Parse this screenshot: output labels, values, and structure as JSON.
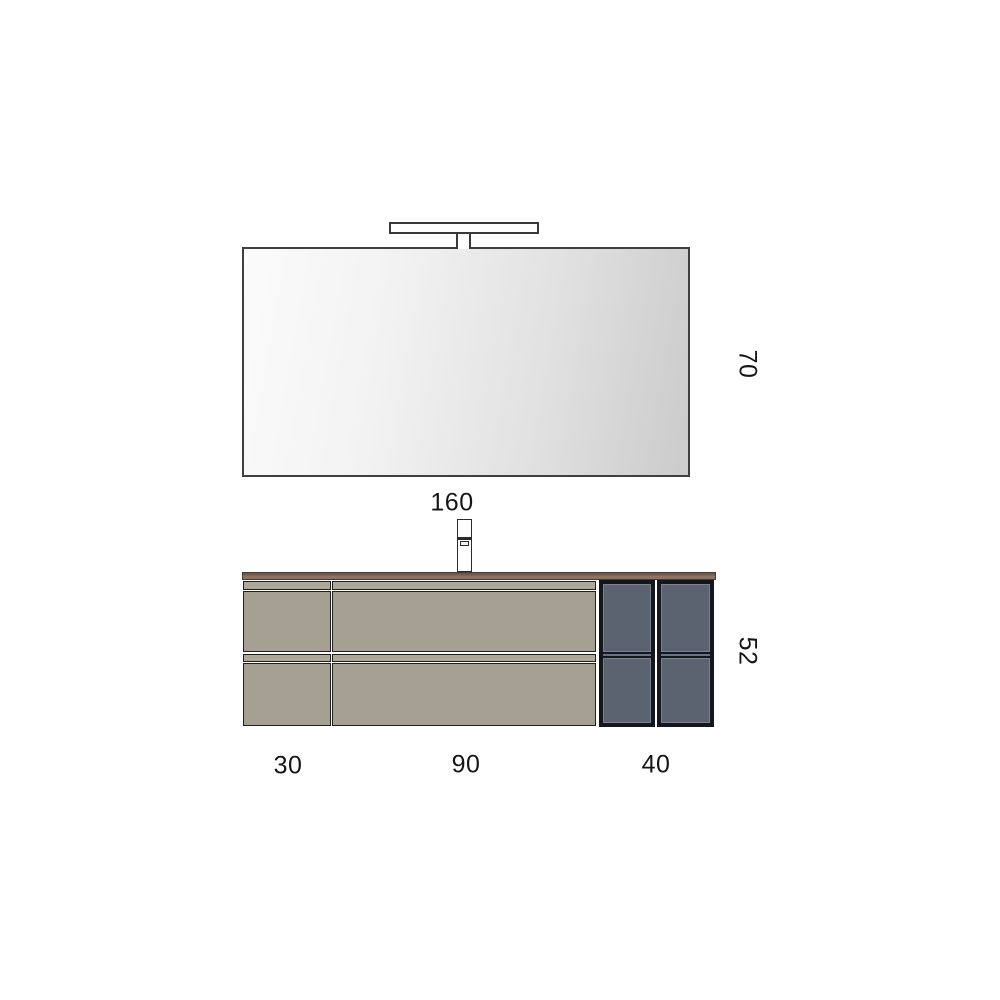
{
  "diagram": {
    "kind": "vanity-technical-drawing",
    "dimensions": {
      "overall_width": "160",
      "mirror_height": "70",
      "cabinet_height": "52",
      "left_module_width": "30",
      "center_module_width": "90",
      "right_module_width": "40"
    },
    "colors": {
      "background": "#ffffff",
      "outline": "#2b2b2b",
      "mirror_gradient_light": "#fbfbfb",
      "mirror_gradient_dark": "#cbcbcb",
      "countertop_top": "#6e5a4d",
      "countertop_bottom": "#8d7365",
      "drawer_strip": "#aea89b",
      "drawer_face": "#a6a093",
      "shelf_frame": "#14181e",
      "shelf_panel": "#5b6370",
      "shelf_panel_edge": "#7b828e",
      "text": "#161616"
    }
  }
}
